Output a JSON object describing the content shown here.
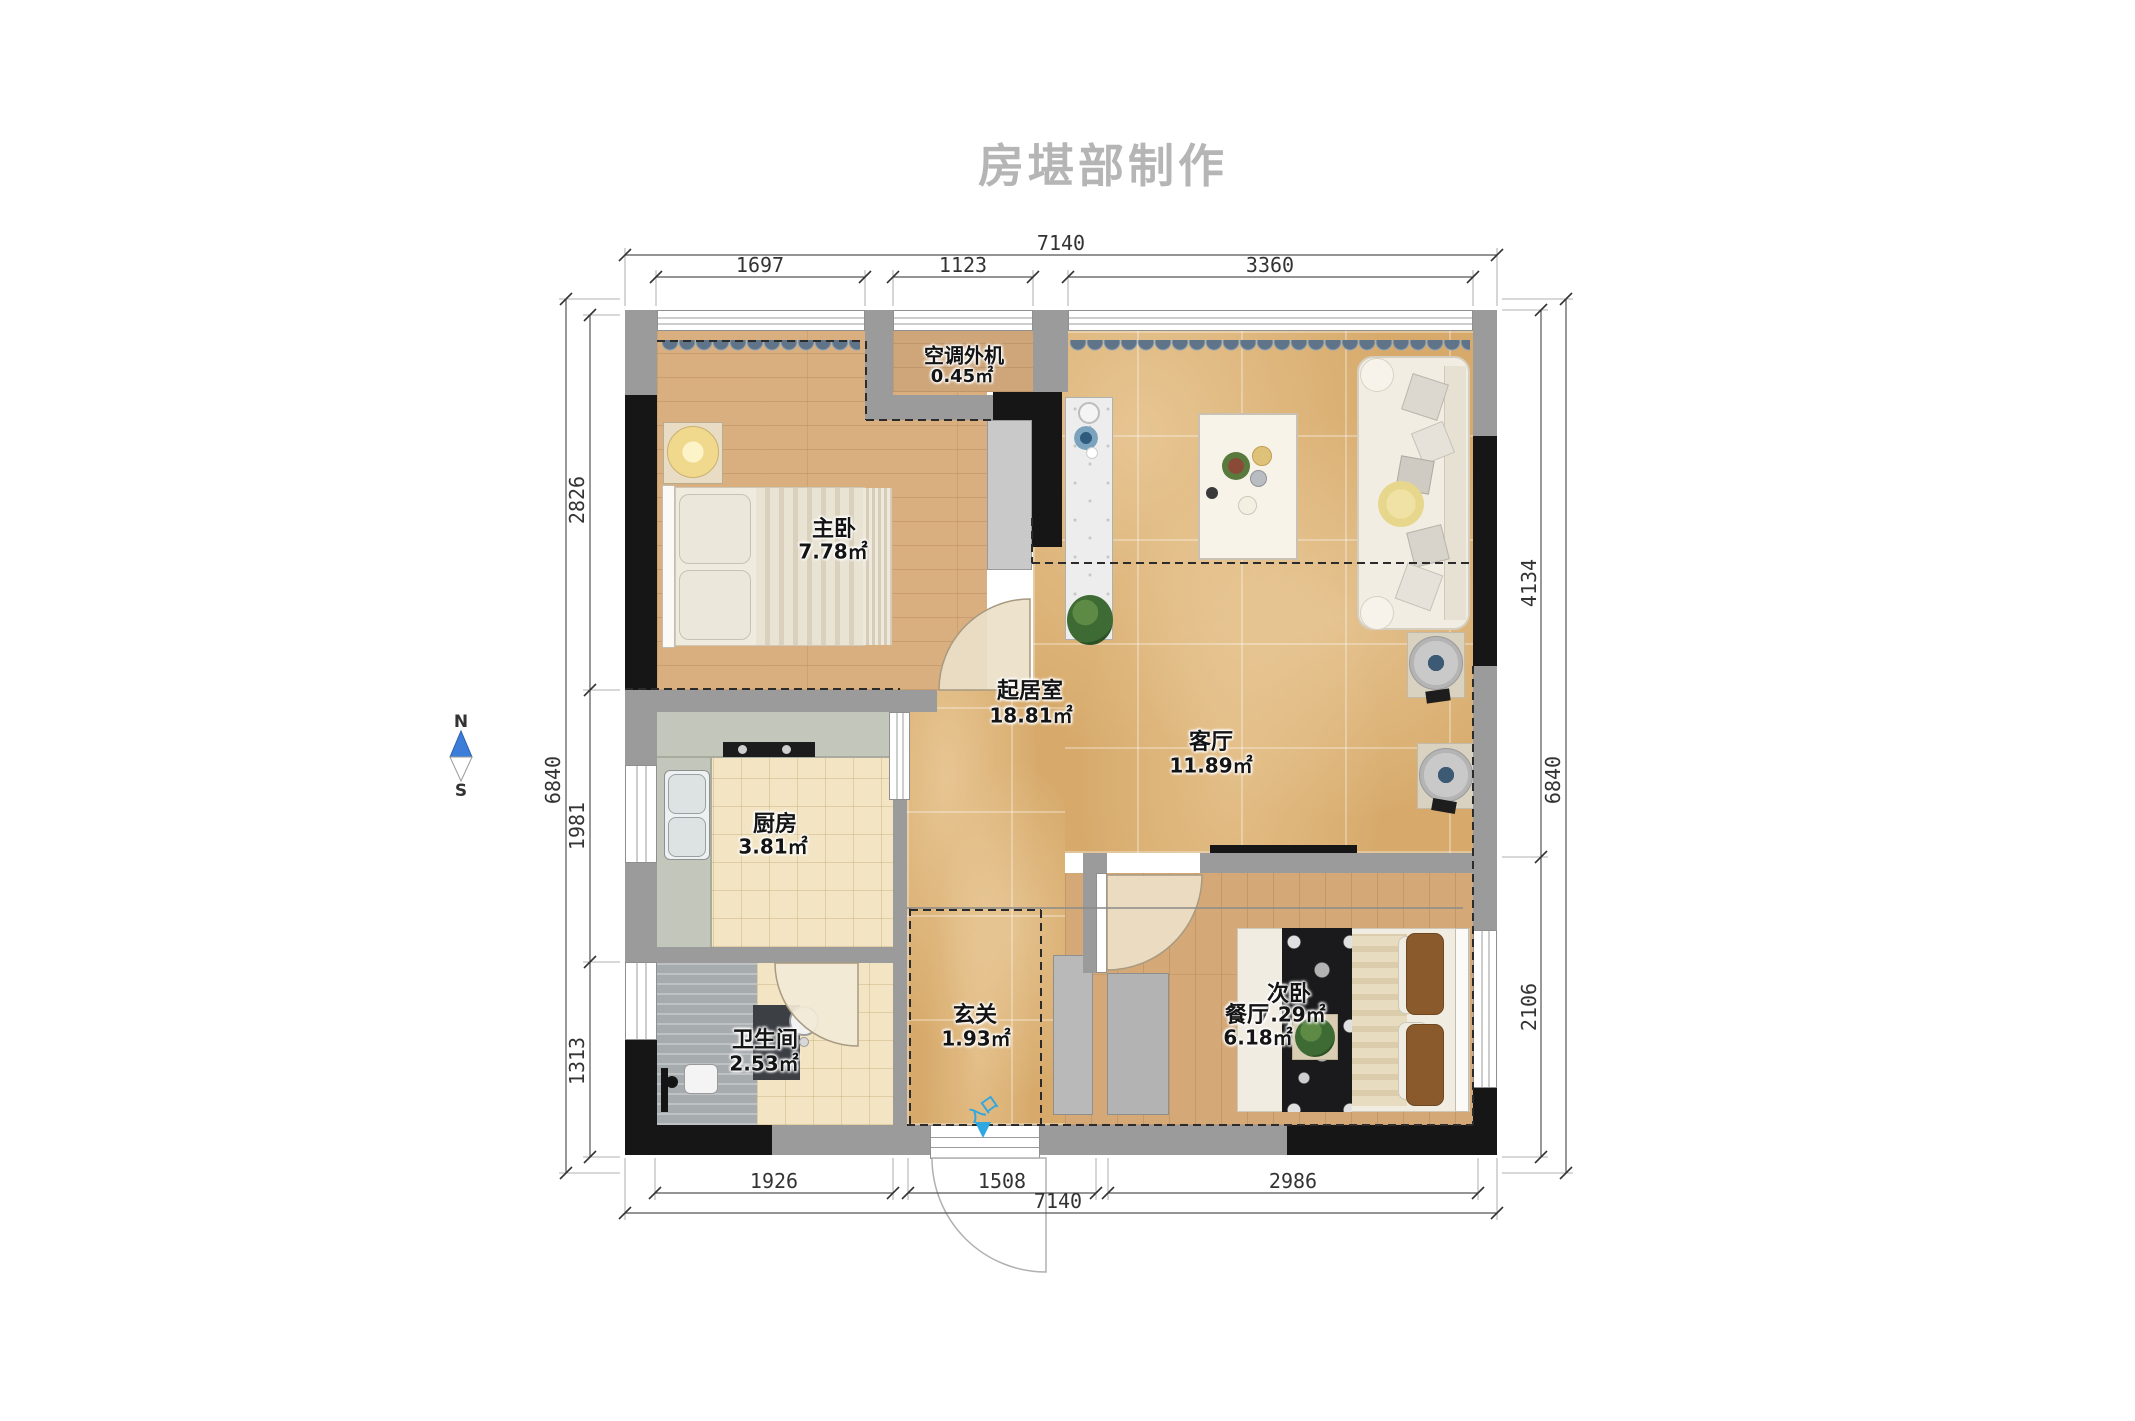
{
  "title": "房堪部制作",
  "compass": {
    "north": "N",
    "south": "S"
  },
  "entrance": {
    "label": "入口"
  },
  "rooms": [
    {
      "name": "主卧",
      "area": "7.78㎡"
    },
    {
      "name": "空调外机",
      "area": "0.45㎡"
    },
    {
      "name": "起居室",
      "area": "18.81㎡"
    },
    {
      "name": "客厅",
      "area": "11.89㎡"
    },
    {
      "name": "厨房",
      "area": "3.81㎡"
    },
    {
      "name": "卫生间",
      "area": "2.53㎡"
    },
    {
      "name": "玄关",
      "area": "1.93㎡"
    },
    {
      "name": "次卧",
      "area": "7.29㎡"
    },
    {
      "name": "餐厅",
      "area": "6.18㎡"
    }
  ],
  "dimensions": {
    "top": {
      "overall": "7140",
      "segments": [
        "1697",
        "1123",
        "3360"
      ]
    },
    "bottom": {
      "overall": "7140",
      "segments": [
        "1926",
        "1508",
        "2986"
      ]
    },
    "left": {
      "overall": "6840",
      "segments": [
        "2826",
        "1981",
        "1313"
      ]
    },
    "right": {
      "overall": "6840",
      "segments": [
        "4134",
        "2106"
      ]
    }
  },
  "colors": {
    "wall_gray": "#9b9b9b",
    "wall_black": "#161616",
    "marble_floor": "#d7aa6b",
    "wood_floor": "#d9af7f",
    "kitchen_floor": "#f3e5c3",
    "bath_floor": "#a6abae",
    "entrance_blue": "#2fa8e1",
    "compass_blue": "#3b7dd8",
    "title_gray": "#b5b5b5"
  }
}
